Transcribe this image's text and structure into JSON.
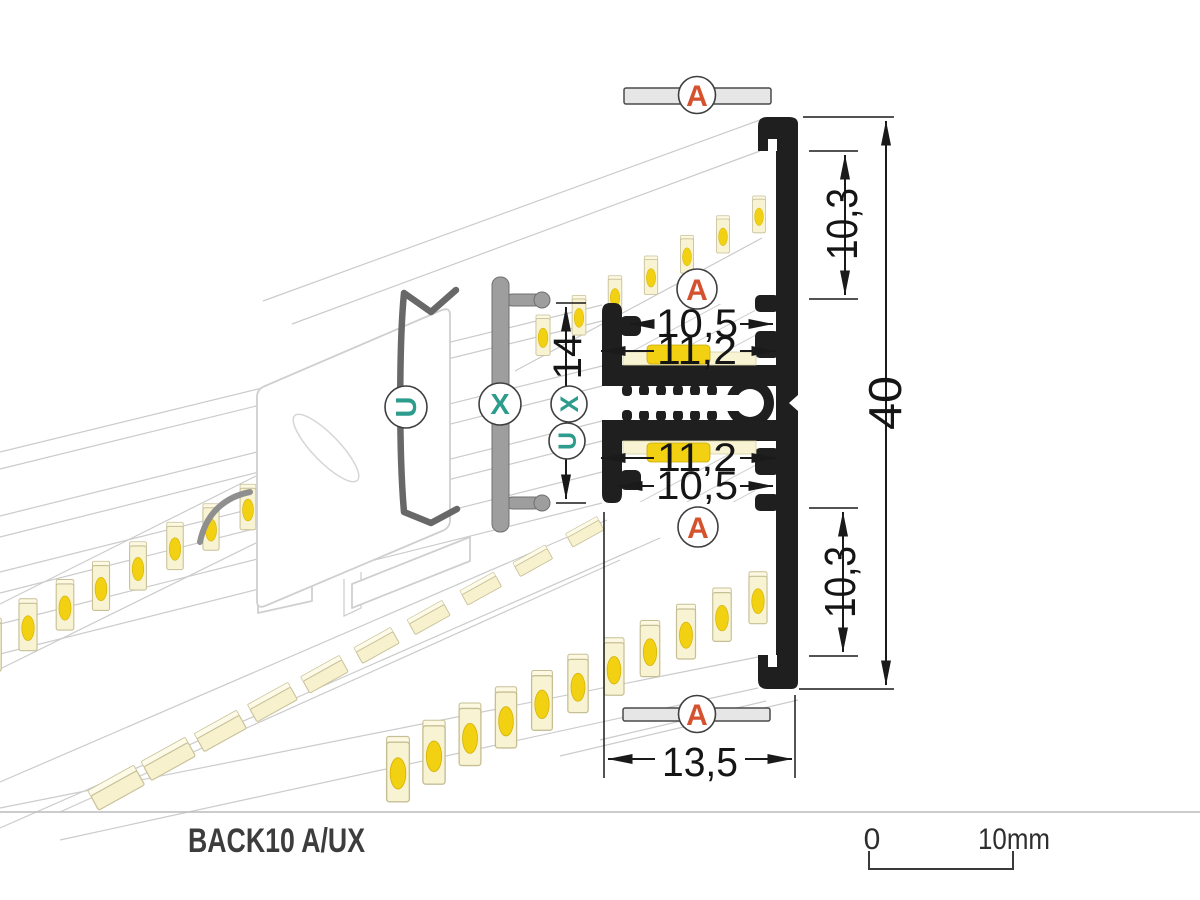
{
  "title": "BACK10 A/UX",
  "scale_bar": {
    "zero_label": "0",
    "ten_label": "10mm"
  },
  "markers": {
    "cover_a": "A",
    "holder_u": "U",
    "extrusion_x": "X"
  },
  "dimensions": {
    "overall_height": "40",
    "upper_offset": "10,3",
    "lower_offset": "10,3",
    "upper_slot_opening": "10,5",
    "upper_slot_inner": "11,2",
    "lower_slot_inner": "11,2",
    "lower_slot_opening": "10,5",
    "center_section_height": "14",
    "profile_depth": "13,5"
  },
  "colors": {
    "profile_black": "#1f1f1f",
    "marker_orange": "#d5522e",
    "marker_teal": "#2d9c8c",
    "cover_gray": "#e6e6e6",
    "metal_gray": "#9e9e9e",
    "clip_gray": "#686868",
    "led_pale": "#f8f3d2",
    "led_bright": "#f2d112",
    "guide_line": "#cbcbcb"
  }
}
